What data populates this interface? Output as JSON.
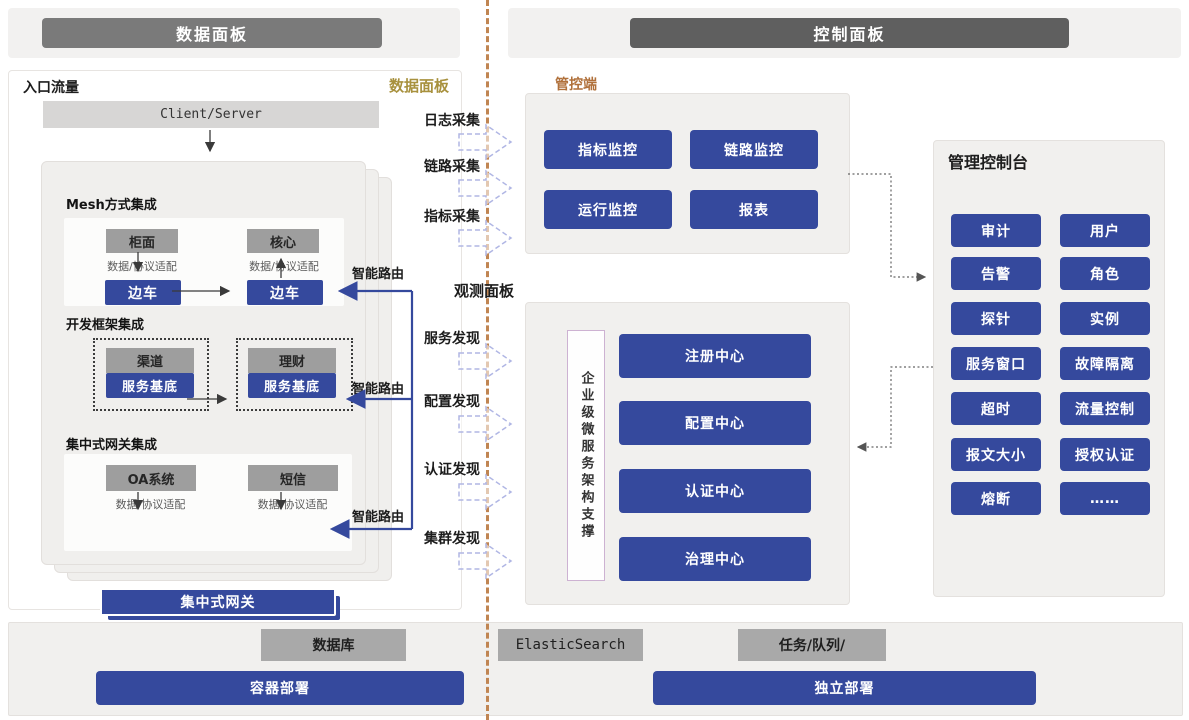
{
  "headers": {
    "left": "数据面板",
    "right": "控制面板"
  },
  "data_panel": {
    "entry_label": "入口流量",
    "corner_label": "数据面板",
    "client_server": "Client/Server",
    "adapter": "数据/协议适配",
    "smart_route": "智能路由",
    "mesh": {
      "title": "Mesh方式集成",
      "box1": "柜面",
      "box2": "核心",
      "sidecar": "边车"
    },
    "framework": {
      "title": "开发框架集成",
      "box1": "渠道",
      "box2": "理财",
      "base": "服务基底"
    },
    "gateway": {
      "title": "集中式网关集成",
      "box1": "OA系统",
      "box2": "短信",
      "bar": "集中式网关"
    }
  },
  "flows": {
    "collect": [
      "日志采集",
      "链路采集",
      "指标采集"
    ],
    "observe_title": "观测面板",
    "discover": [
      "服务发现",
      "配置发现",
      "认证发现",
      "集群发现"
    ]
  },
  "control_panel": {
    "mgmt_label": "管控端",
    "mgmt_buttons": [
      "指标监控",
      "链路监控",
      "运行监控",
      "报表"
    ],
    "observation": {
      "support_label": "企业级微服务架构支撑",
      "centers": [
        "注册中心",
        "配置中心",
        "认证中心",
        "治理中心"
      ]
    },
    "console": {
      "title": "管理控制台",
      "buttons": [
        "审计",
        "用户",
        "告警",
        "角色",
        "探针",
        "实例",
        "服务窗口",
        "故障隔离",
        "超时",
        "流量控制",
        "报文大小",
        "授权认证",
        "熔断",
        "……"
      ]
    }
  },
  "infrastructure": {
    "database": "数据库",
    "elasticsearch": "ElasticSearch",
    "task_queue": "任务/队列/",
    "container_deploy": "容器部署",
    "standalone_deploy": "独立部署"
  },
  "colors": {
    "accent_blue": "#35499d",
    "gray_node": "#9e9e9e",
    "divider_brown": "#c08552",
    "gold_label": "#a8913e",
    "brown_label": "#b0703a"
  }
}
